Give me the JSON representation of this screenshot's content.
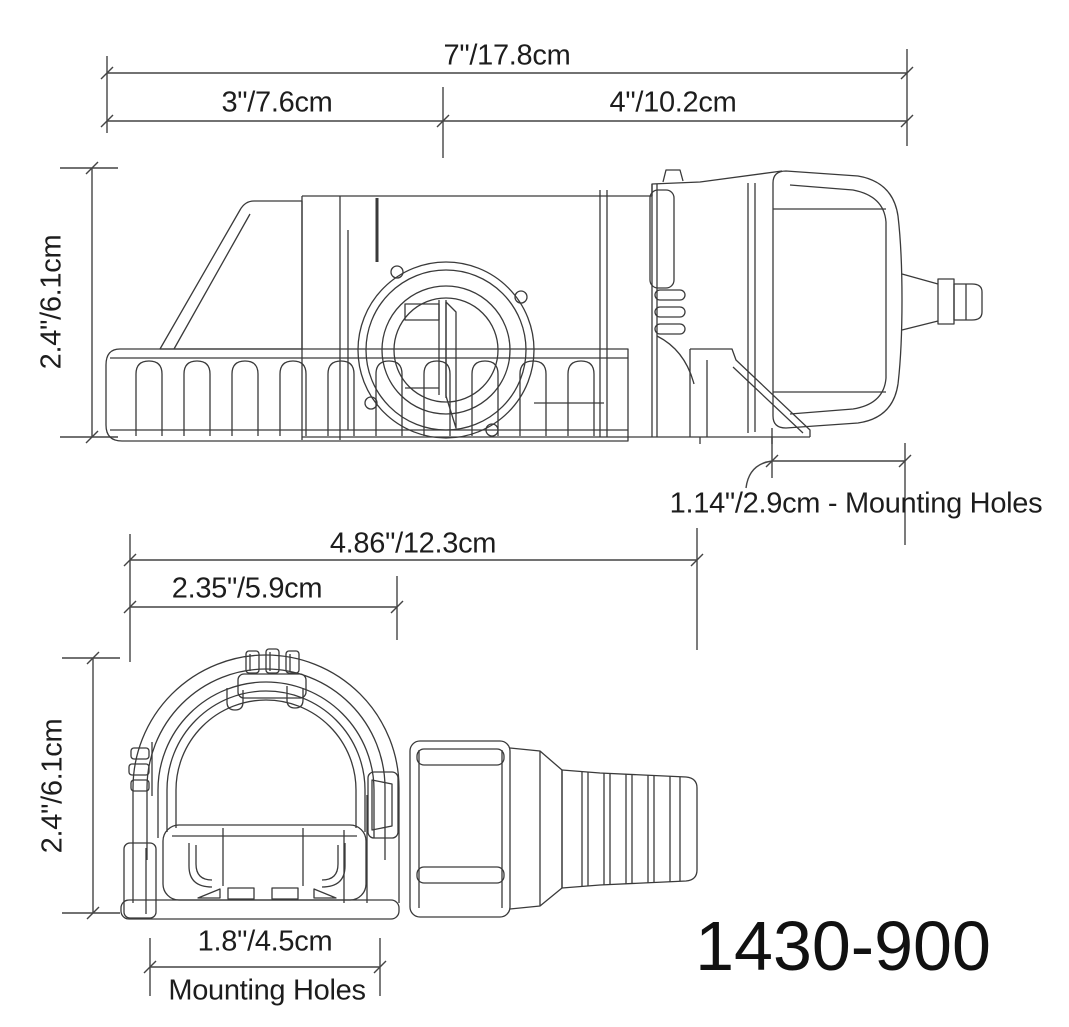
{
  "page": {
    "background": "#ffffff",
    "line_color": "#3a3a3a",
    "text_color": "#1d1d1d"
  },
  "side_view": {
    "dim_overall_length": "7\"/17.8cm",
    "dim_front_section": "3\"/7.6cm",
    "dim_rear_section": "4\"/10.2cm",
    "dim_height": "2.4\"/6.1cm",
    "dim_mounting_holes": "1.14\"/2.9cm - Mounting Holes"
  },
  "front_view": {
    "dim_overall_width": "4.86\"/12.3cm",
    "dim_body_width": "2.35\"/5.9cm",
    "dim_height": "2.4\"/6.1cm",
    "dim_mounting_width": "1.8\"/4.5cm",
    "mounting_label": "Mounting Holes"
  },
  "model_number": "1430-900"
}
